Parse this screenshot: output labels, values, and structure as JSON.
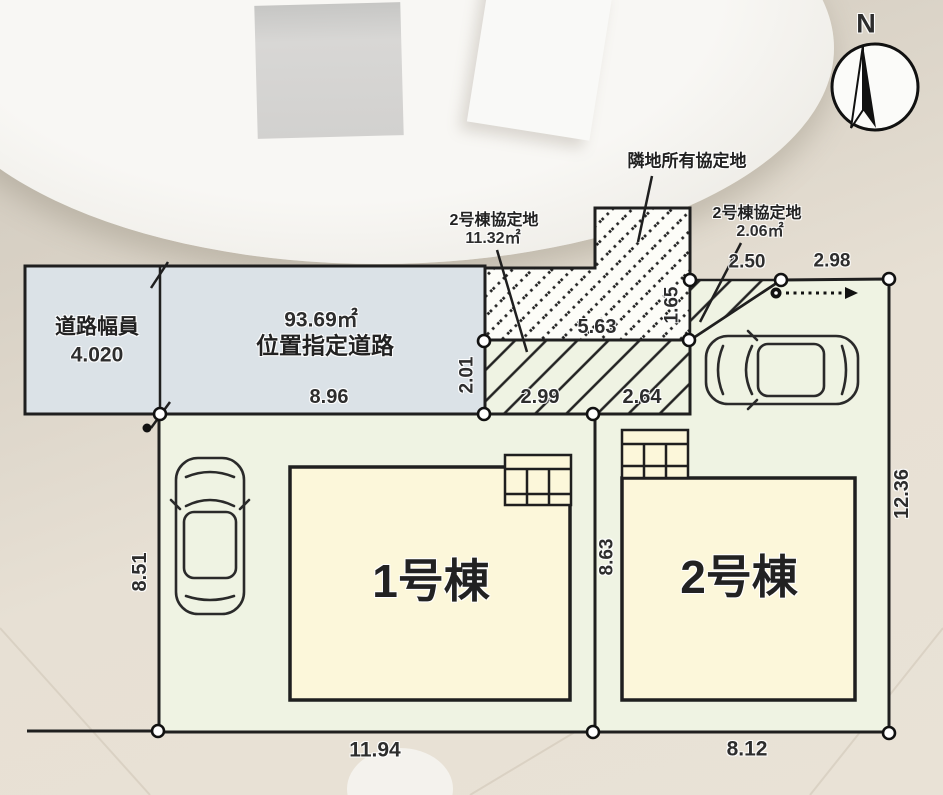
{
  "compass": {
    "north_label": "N"
  },
  "road": {
    "width_label": "道路幅員",
    "width_value": "4.020",
    "area": "93.69㎡",
    "name": "位置指定道路",
    "frontage": "8.96"
  },
  "agreement_areas": {
    "neighbor_label": "隣地所有協定地",
    "bldg2_main_label": "2号棟協定地",
    "bldg2_main_area": "11.32㎡",
    "bldg2_side_label": "2号棟協定地",
    "bldg2_side_area": "2.06㎡"
  },
  "buildings": {
    "b1_label": "1号棟",
    "b2_label": "2号棟"
  },
  "dimensions": {
    "strip_height": "2.01",
    "strip_width_total": "5.63",
    "strip_width_left": "2.99",
    "strip_width_right": "2.64",
    "triangle_height": "1.65",
    "triangle_width": "2.50",
    "lot2_top_edge": "2.98",
    "lot1_west_edge": "8.51",
    "lot_divider": "8.63",
    "lot2_east_edge": "12.36",
    "lot1_south_edge": "11.94",
    "lot2_south_edge": "8.12"
  },
  "colors": {
    "road_fill": "#dbe2e7",
    "lot_fill": "#eff3e3",
    "building_fill": "#fcf7da",
    "hatch_area_fill": "#fdfdf8",
    "line": "#1f1f1f"
  }
}
